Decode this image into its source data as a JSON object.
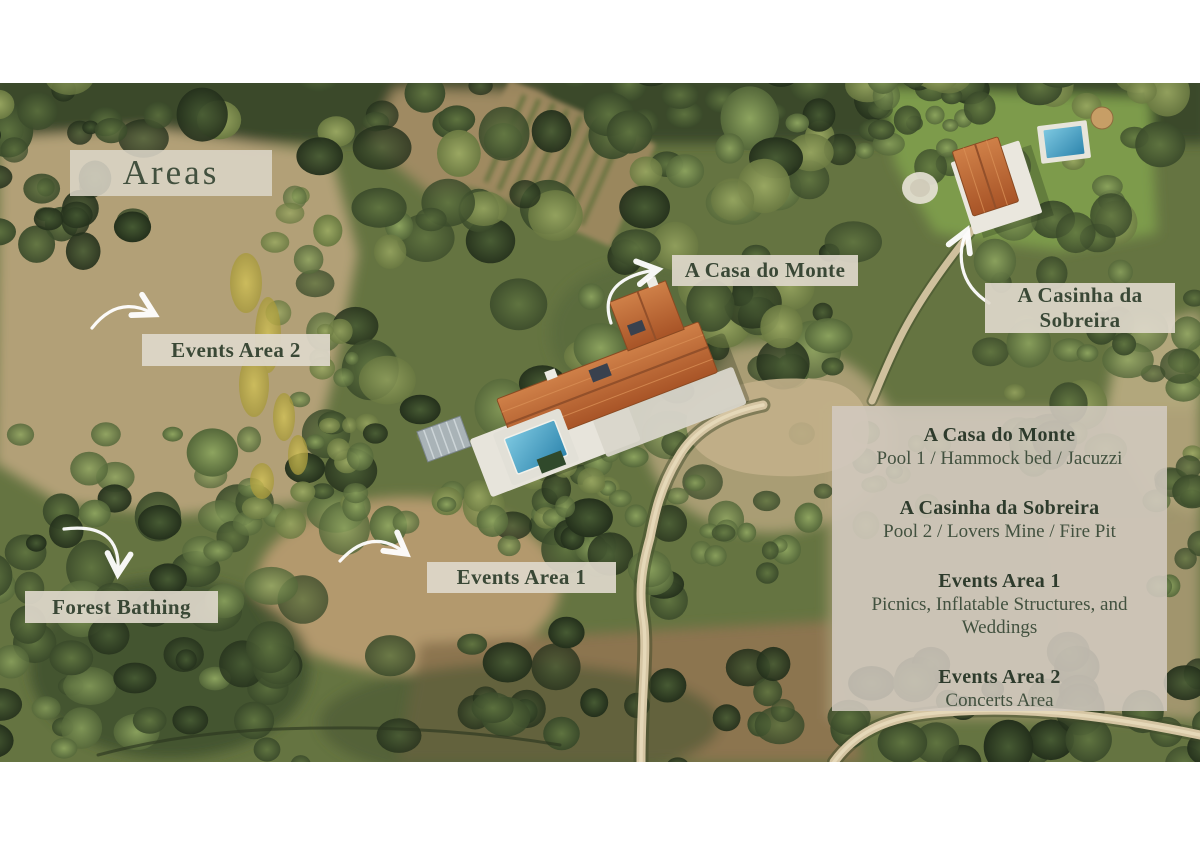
{
  "page": {
    "title": "Areas"
  },
  "map_labels": {
    "events_area_2": "Events Area 2",
    "casa_do_monte": "A Casa do Monte",
    "casinha": "A Casinha da\nSobreira",
    "events_area_1": "Events Area 1",
    "forest_bathing": "Forest Bathing"
  },
  "legend": {
    "sections": [
      {
        "heading": "A Casa do Monte",
        "description": "Pool 1 / Hammock bed / Jacuzzi"
      },
      {
        "heading": "A Casinha da Sobreira",
        "description": "Pool 2 / Lovers Mine / Fire Pit"
      },
      {
        "heading": "Events Area 1",
        "description": "Picnics, Inflatable Structures, and Weddings"
      },
      {
        "heading": "Events Area 2",
        "description": "Concerts Area"
      }
    ]
  },
  "annotations": {
    "arrow_style": "curved-white-arrow",
    "arrows": [
      "events-area-2-arrow",
      "casa-do-monte-arrow",
      "casinha-arrow",
      "events-area-1-arrow",
      "forest-bathing-arrow"
    ]
  },
  "colors": {
    "label_background": "#ded8cb",
    "panel_background": "#d1cabf",
    "label_text": "#3a4836",
    "arrow": "#ffffff",
    "roof_terracotta": "#b96a35",
    "pool_blue": "#57aed2",
    "field_tan": "#b2a077",
    "forest_green": "#4a5e33",
    "page_background": "#ffffff"
  }
}
